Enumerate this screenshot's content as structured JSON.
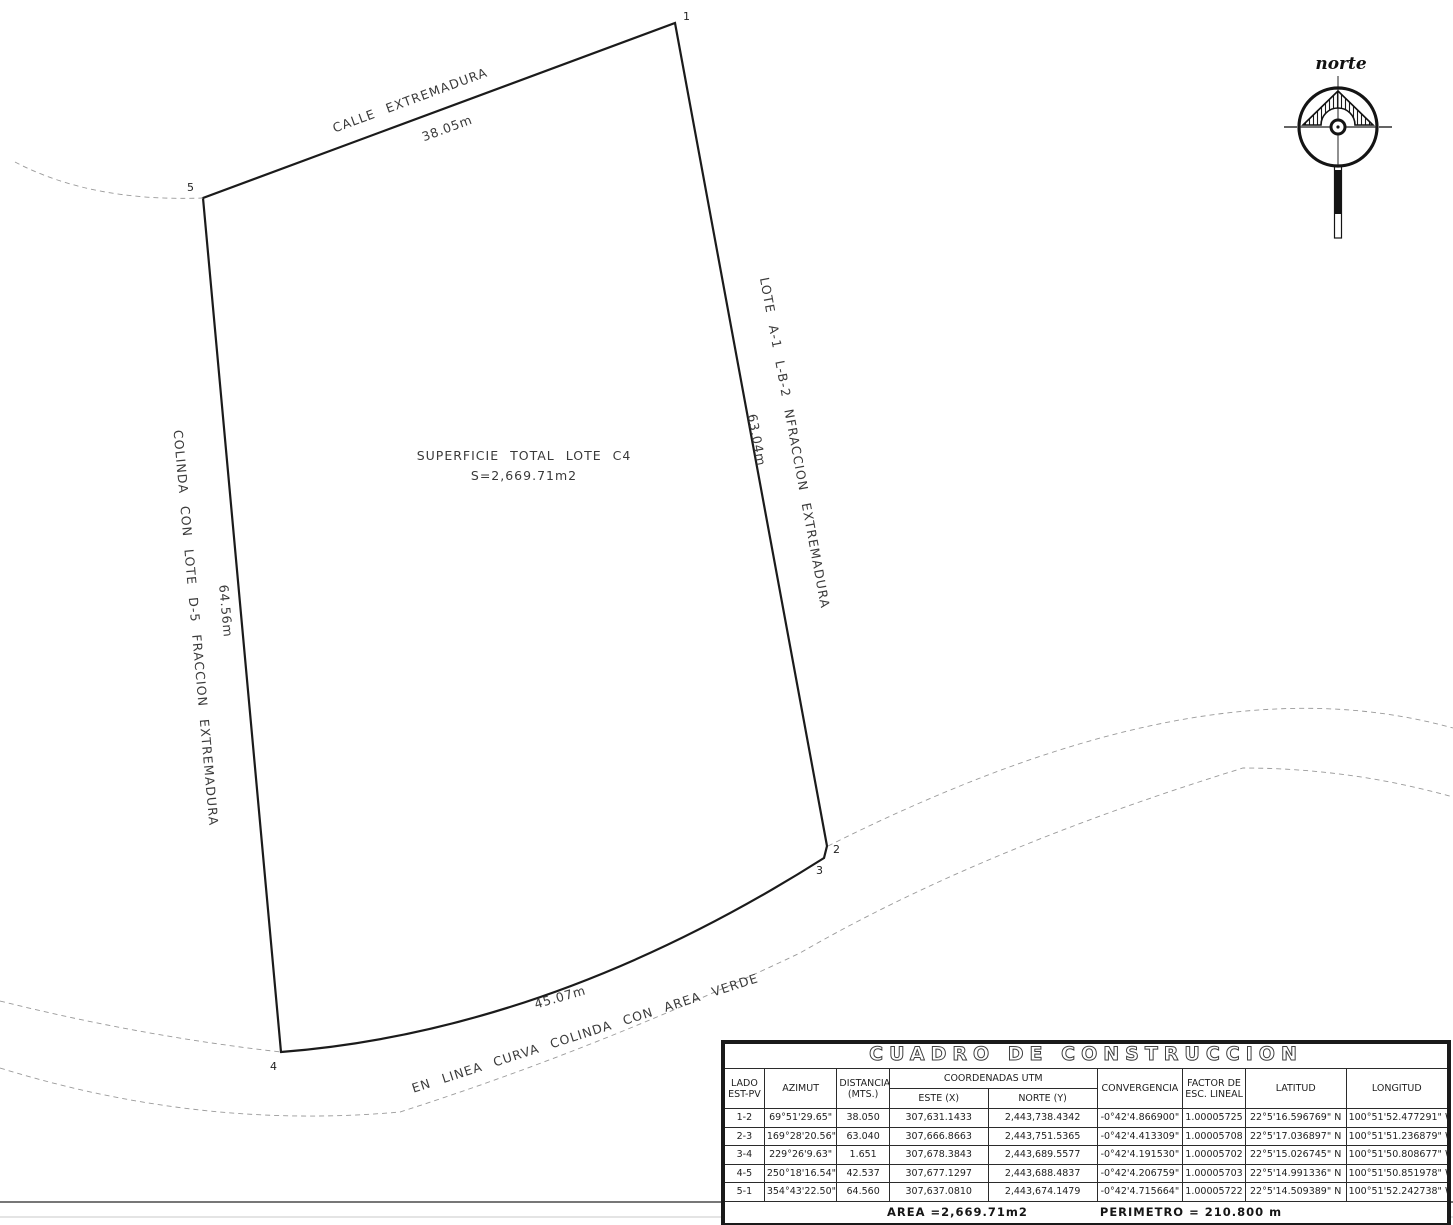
{
  "drawing": {
    "north_label": "norte",
    "center_note": {
      "line1": "SUPERFICIE TOTAL LOTE C4",
      "line2": "S=2,669.71m2"
    },
    "edges": {
      "top": {
        "name": "CALLE EXTREMADURA",
        "length": "38.05m"
      },
      "right": {
        "name": "LOTE A-1 L-B-2 NFRACCION EXTREMADURA",
        "length": "63.04m"
      },
      "left": {
        "name": "COLINDA CON LOTE D-5 FRACCION EXTREMADURA",
        "length": "64.56m"
      },
      "bottom": {
        "name": "EN LINEA CURVA COLINDA CON AREA VERDE",
        "length": "45.07m"
      }
    },
    "vertices": [
      "1",
      "2",
      "3",
      "4",
      "5"
    ]
  },
  "table": {
    "title": "CUADRO DE CONSTRUCCION",
    "headers": {
      "lado1": "LADO",
      "lado2": "EST-PV",
      "azimut": "AZIMUT",
      "dist1": "DISTANCIA",
      "dist2": "(MTS.)",
      "coords": "COORDENADAS UTM",
      "este": "ESTE (X)",
      "norte": "NORTE (Y)",
      "conv": "CONVERGENCIA",
      "factor1": "FACTOR DE",
      "factor2": "ESC. LINEAL",
      "lat": "LATITUD",
      "lon": "LONGITUD"
    },
    "rows": [
      {
        "lado": "1-2",
        "azimut": "69°51'29.65\"",
        "dist": "38.050",
        "este": "307,631.1433",
        "norte": "2,443,738.4342",
        "conv": "-0°42'4.866900\"",
        "factor": "1.00005725",
        "lat": "22°5'16.596769\"  N",
        "lon": "100°51'52.477291\"  W"
      },
      {
        "lado": "2-3",
        "azimut": "169°28'20.56\"",
        "dist": "63.040",
        "este": "307,666.8663",
        "norte": "2,443,751.5365",
        "conv": "-0°42'4.413309\"",
        "factor": "1.00005708",
        "lat": "22°5'17.036897\"  N",
        "lon": "100°51'51.236879\"  W"
      },
      {
        "lado": "3-4",
        "azimut": "229°26'9.63\"",
        "dist": "1.651",
        "este": "307,678.3843",
        "norte": "2,443,689.5577",
        "conv": "-0°42'4.191530\"",
        "factor": "1.00005702",
        "lat": "22°5'15.026745\"  N",
        "lon": "100°51'50.808677\"  W"
      },
      {
        "lado": "4-5",
        "azimut": "250°18'16.54\"",
        "dist": "42.537",
        "este": "307,677.1297",
        "norte": "2,443,688.4837",
        "conv": "-0°42'4.206759\"",
        "factor": "1.00005703",
        "lat": "22°5'14.991336\"  N",
        "lon": "100°51'50.851978\"  W"
      },
      {
        "lado": "5-1",
        "azimut": "354°43'22.50\"",
        "dist": "64.560",
        "este": "307,637.0810",
        "norte": "2,443,674.1479",
        "conv": "-0°42'4.715664\"",
        "factor": "1.00005722",
        "lat": "22°5'14.509389\"  N",
        "lon": "100°51'52.242738\"  W"
      }
    ],
    "footer": {
      "area": "AREA =2,669.71m2",
      "perimetro": "PERIMETRO = 210.800 m"
    }
  }
}
